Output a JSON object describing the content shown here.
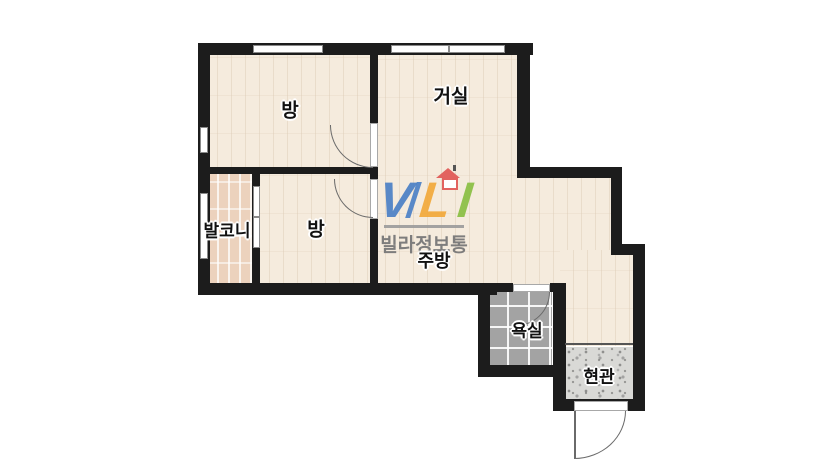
{
  "floorplan": {
    "rooms": [
      {
        "id": "room-top-left",
        "name": "방"
      },
      {
        "id": "living-room",
        "name": "거실"
      },
      {
        "id": "balcony",
        "name": "발코니"
      },
      {
        "id": "room-middle",
        "name": "방"
      },
      {
        "id": "kitchen",
        "name": "주방"
      },
      {
        "id": "bathroom",
        "name": "욕실"
      },
      {
        "id": "entrance",
        "name": "현관"
      }
    ],
    "watermark": {
      "letters": [
        {
          "char": "V",
          "color": "#4b80c6"
        },
        {
          "char": "L",
          "color": "#f2a93b"
        },
        {
          "char": "I",
          "color": "#8abf43"
        }
      ],
      "brand_text": "빌라정보통",
      "brand_text_color": "#787878",
      "house_icon_color": "#e2635f",
      "baseline_bar_color": "#9a9a9a"
    },
    "colors": {
      "wall": "#1c1c1c",
      "room_floor": "#f5ebdd",
      "balcony_floor": "#ecd2bd",
      "bathroom_floor": "#a3a3a3",
      "entrance_floor": "#d9d9d6",
      "door_arc": "#6a6a6a",
      "window_frame": "#8a8a8a",
      "background": "#ffffff"
    }
  }
}
